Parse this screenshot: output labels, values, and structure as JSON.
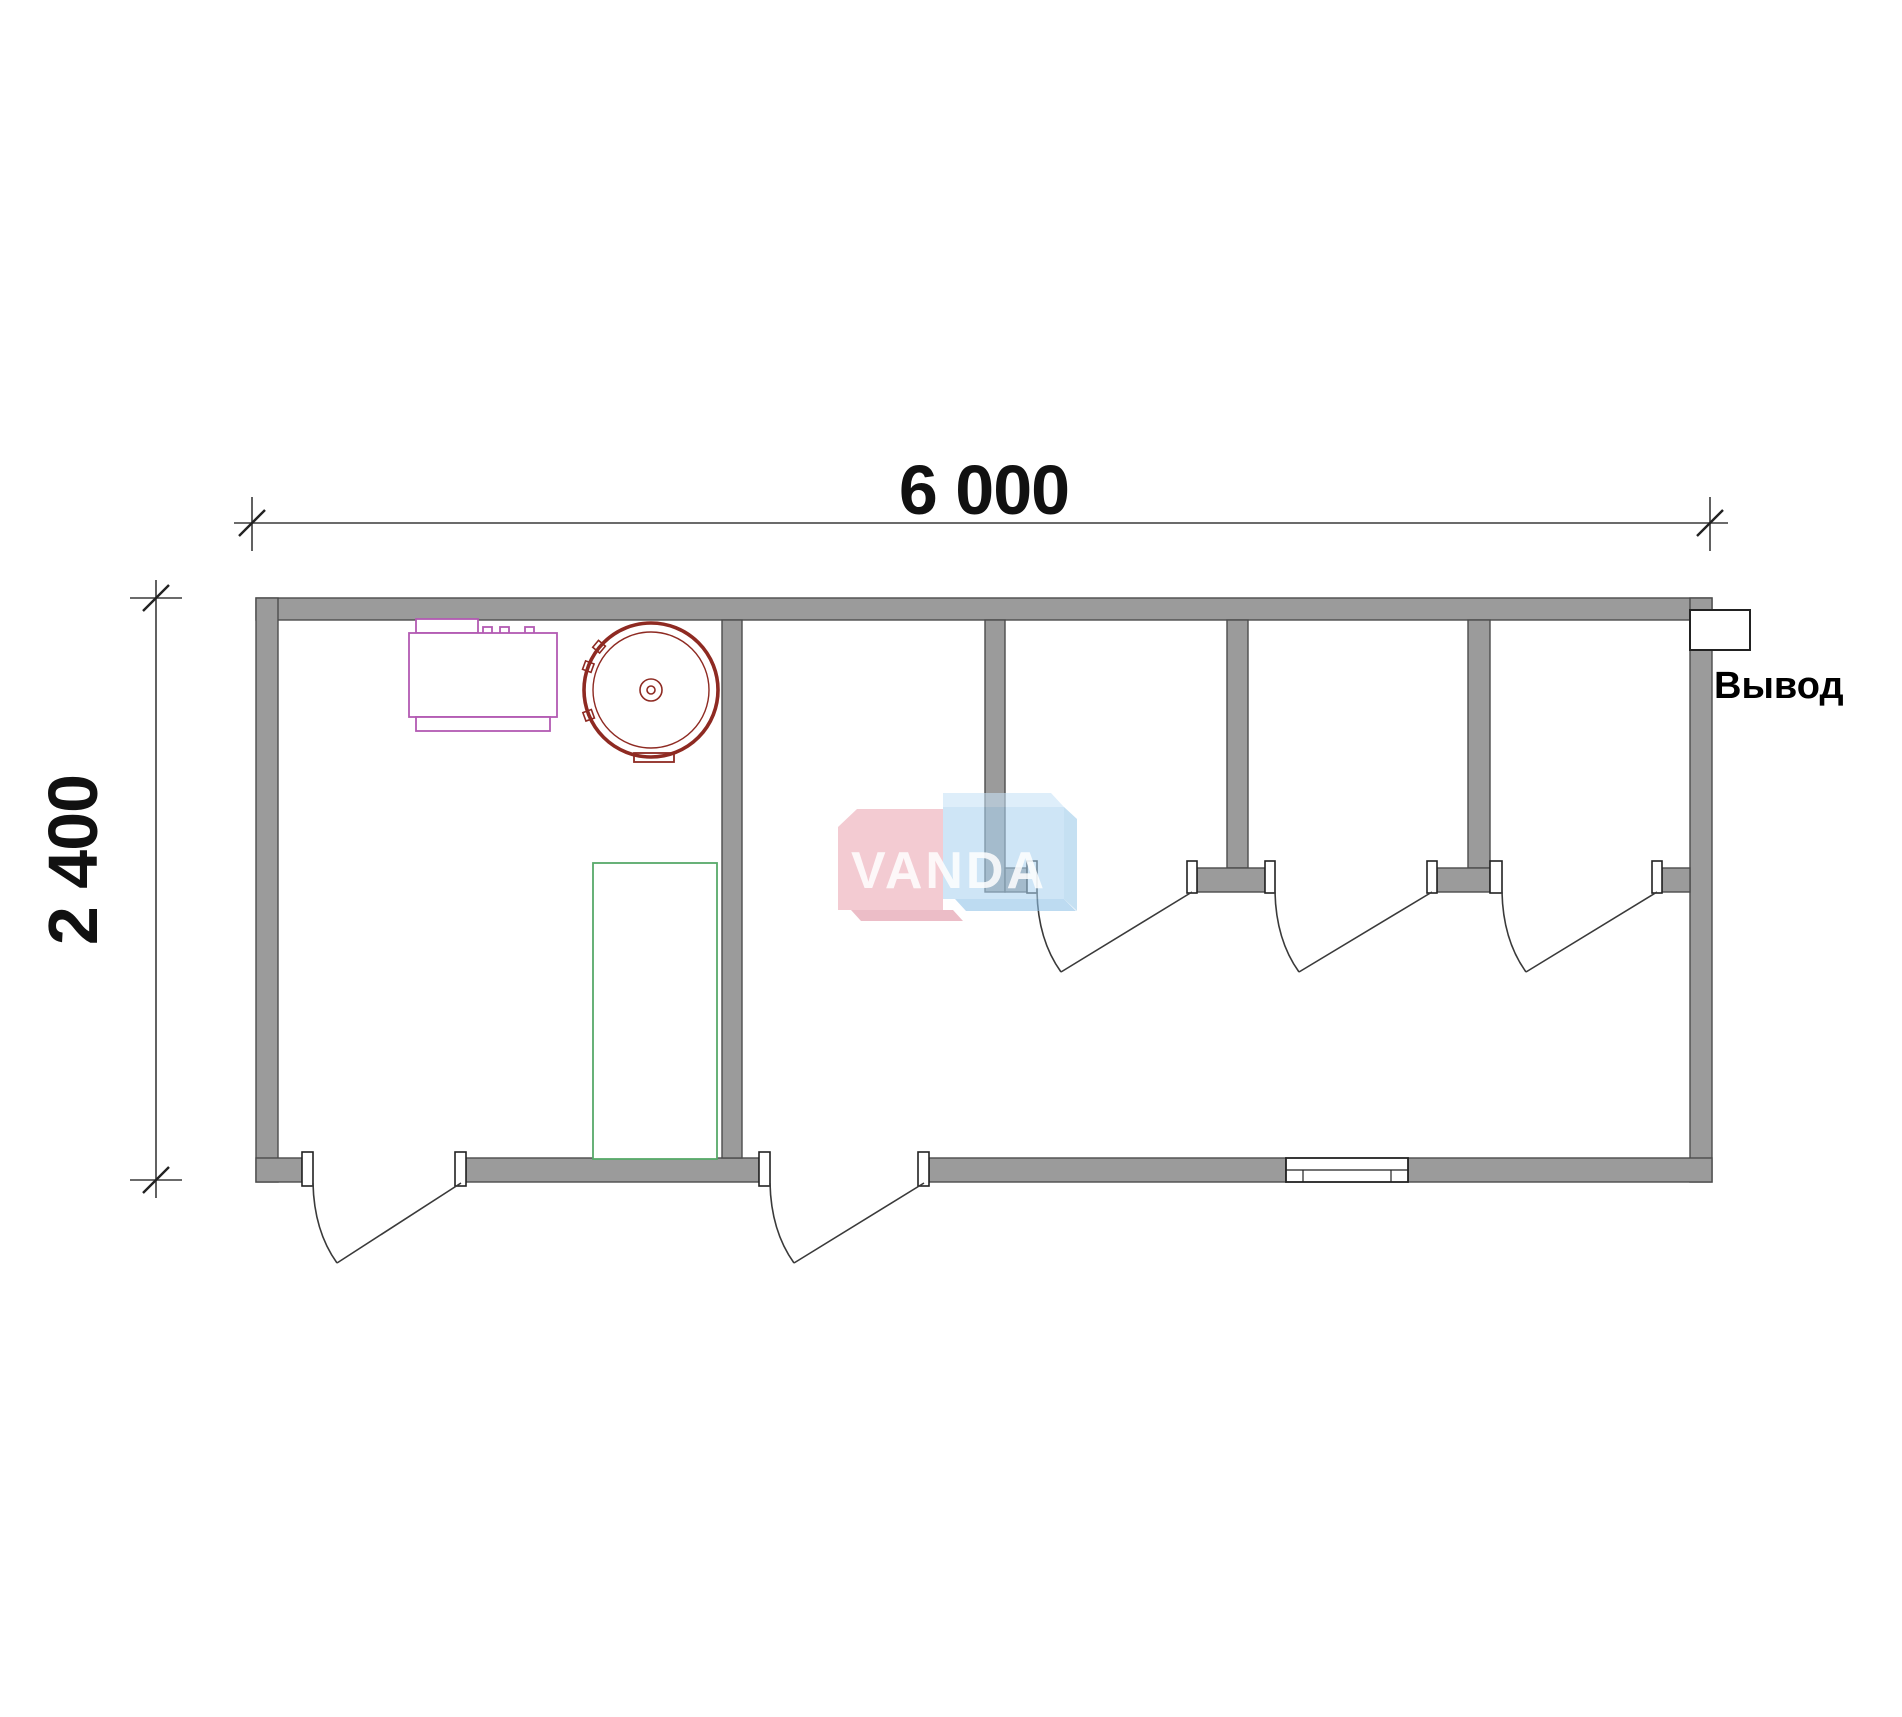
{
  "page": {
    "background": "#ffffff"
  },
  "dimensions": {
    "top": {
      "label": "6 000",
      "value_mm": 6000
    },
    "left": {
      "label": "2 400",
      "value_mm": 2400
    }
  },
  "outlet": {
    "label": "Вывод"
  },
  "watermark": {
    "text": "VANDA"
  },
  "colors": {
    "page_bg": "#ffffff",
    "wall_fill": "#9b9b9b",
    "wall_edge": "#4c4c4c",
    "line": "#3a3a3a",
    "fixture_line": "#2b2b2b",
    "equip_purple": "#b25ab2",
    "heater_red": "#8e2a22",
    "shower_green": "#58a96a",
    "wm_pink": "#eba6b2",
    "wm_pink_dark": "#df8fa0",
    "wm_blue": "#abd3f0",
    "wm_blue_light": "#c8e3f7",
    "wm_blue_mid": "#8fc2e8",
    "wm_blue_dark": "#9ccae9",
    "wm_text": "#ffffff",
    "dim_text": "#111111"
  },
  "plan": {
    "rooms": [
      "technical-room",
      "washroom",
      "wc-stall-1",
      "wc-stall-2",
      "wc-stall-3"
    ],
    "toilets": [
      {
        "cx": 1116
      },
      {
        "cx": 1358
      },
      {
        "cx": 1590
      }
    ],
    "sinks": [
      {
        "cx": 807
      },
      {
        "cx": 921
      }
    ],
    "stall_doors": [
      {
        "jamb_left_x": 1037,
        "hinge_x": 1192,
        "y": 892
      },
      {
        "jamb_left_x": 1275,
        "hinge_x": 1432,
        "y": 892
      },
      {
        "jamb_left_x": 1502,
        "hinge_x": 1657,
        "y": 892
      }
    ],
    "entry_doors": [
      {
        "jamb_left_x": 313,
        "hinge_x": 461,
        "y": 1183
      },
      {
        "jamb_left_x": 770,
        "hinge_x": 924,
        "y": 1183
      }
    ],
    "door_drop": 80,
    "door_dx": 24
  }
}
